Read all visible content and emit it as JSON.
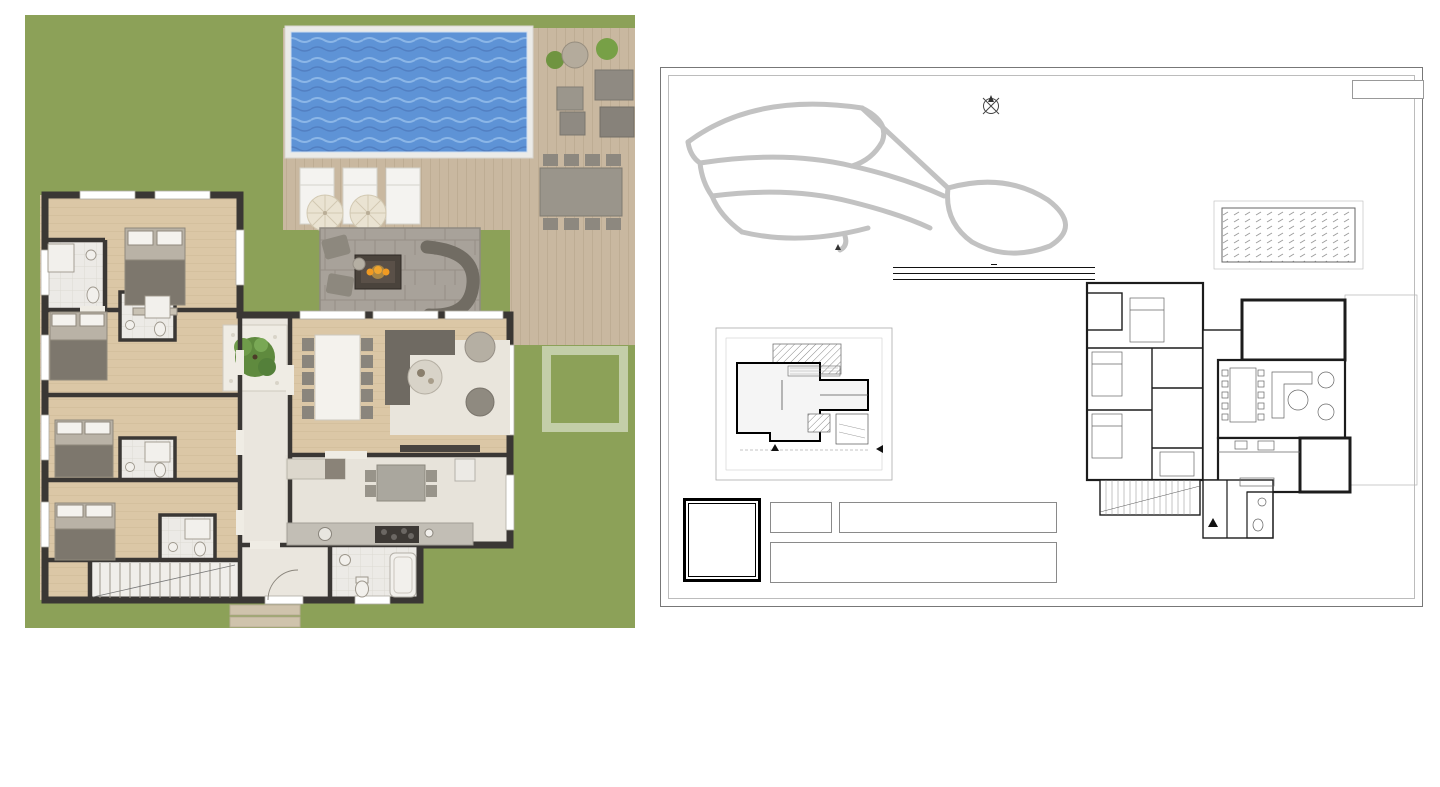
{
  "watermark": {
    "logo_letter": "T",
    "ghost_text": "TE"
  },
  "left_plan": {
    "room_labels": [
      "E YATAK ODASI",
      "E.BANYO",
      "BANYO",
      "YATAK ODASI",
      "YATAK ODASI",
      "BANYO",
      "YATAK ODASI",
      "BANYO",
      "HOL",
      "MUTFAK",
      "ANTRE",
      "WC"
    ]
  },
  "sheet": {
    "uygulama_label": "UYGULAMA",
    "compass_letter": "K",
    "site_plan": {
      "entry_label": "SİTE GİRİŞİ"
    },
    "net_table": {
      "title": "NET ALANLAR :",
      "header": {
        "label": "DAİRE İÇİ NET ALANLAR",
        "value": ": 159,66 m²"
      },
      "rows": [
        {
          "label": "ANTRE",
          "value": ": 3,29 m²"
        },
        {
          "label": "VESTİYER",
          "value": ": 3,06 m²"
        },
        {
          "label": "SALON",
          "value": ": 39,83 m²"
        },
        {
          "label": "MUTFAK",
          "value": ": 15,01 m²"
        },
        {
          "label": "WC",
          "value": ": 2,60 m²"
        },
        {
          "label": "HOL",
          "value": ": 13,48 m²"
        },
        {
          "label": "YATAK ODASI-1",
          "value": ": 14,98 m²"
        },
        {
          "label": "BANYO-1",
          "value": ": 3,41 m²"
        },
        {
          "label": "YATAK ODASI-2",
          "value": ": 13,84 m²"
        },
        {
          "label": "BANYO-2",
          "value": ": 2,92 m²"
        },
        {
          "label": "YATAK ODASI-3",
          "value": ": 14,06 m²"
        },
        {
          "label": "BANYO-3",
          "value": ": 3,28 m²"
        },
        {
          "label": "E.YATAK ODASI",
          "value": ": 20,71 m²"
        },
        {
          "label": "E.BANYO",
          "value": ": 3,50 m²"
        },
        {
          "label": "MERDİVEN",
          "value": ": 5,69 m²"
        }
      ],
      "subtotal": {
        "label": "TAHSİSLİ NET ALANLAR",
        "value": ": 130,50 m²"
      },
      "extra_rows": [
        {
          "label": "HAVUZ",
          "value": ": 32,00 m²"
        },
        {
          "label": "KIŞ BAHÇESİ - 1",
          "value": ": 18,79 m²"
        },
        {
          "label": "KIŞ BAHÇESİ - 2",
          "value": ": 7,78 m²"
        },
        {
          "label": "TERAS",
          "value": ": 71,93 m²"
        }
      ],
      "total": {
        "label": "BAHÇE",
        "value": ": 383,23 m²"
      }
    },
    "key_plan": {
      "havuz": "HAVUZ",
      "teras": "TERAS",
      "bahce": "BAHÇE",
      "otopark": "OTOPARK",
      "villa_entry_line1": "VİLLA",
      "villa_entry_line2": "GİRİŞİ",
      "garden_entry_line1": "BAHÇE",
      "garden_entry_line2": "GİRİŞİ"
    },
    "floor_plan": {
      "rooms": [
        {
          "name": "E YATAK ODASI",
          "area": "A: 20,71 m²"
        },
        {
          "name": "E.BANYO",
          "area": "A: 3,50 m²"
        },
        {
          "name": "BANYO-2",
          "area": "A: 2,92 m²"
        },
        {
          "name": "YATAK ODASI-2",
          "area": "A: 13,84 m²"
        },
        {
          "name": "YATAK ODASI-3",
          "area": "A: 14,06 m²"
        },
        {
          "name": "BANYO-3",
          "area": "A: 3,28 m²"
        },
        {
          "name": "YATAK ODASI-1",
          "area": "A: 14,98 m²"
        },
        {
          "name": "BANYO-1",
          "area": "A: 3,41 m²"
        },
        {
          "name": "HOL",
          "area": "A: 13,48 m²"
        },
        {
          "name": "MERDİVEN",
          "area": "A: 5,69 m²"
        },
        {
          "name": "ANTRE",
          "area": "A: 3,29 m²"
        },
        {
          "name": "VESTİYER",
          "area": "A: 3,06 m²"
        },
        {
          "name": "WC",
          "area": "A: 2,60 m²"
        },
        {
          "name": "MUTFAK",
          "area": "A: 15,01 m²"
        },
        {
          "name": "KIŞ BAHÇESİ - 2",
          "area": "A: 7,78 m²"
        },
        {
          "name": "SALON",
          "area": "A: 39,83 m²"
        },
        {
          "name": "KIŞ BAHÇESİ - 1",
          "area": "A: 18,79 m²"
        },
        {
          "name": "TERAS",
          "area": "A: 71,93 m²"
        }
      ],
      "villa_entry_line1": "VİLLA",
      "villa_entry_line2": "GİRİŞİ"
    },
    "title_block": {
      "unit_label_line1": "Bağ. Böl.",
      "unit_label_line2": "No:",
      "unit_no": "BS-1",
      "room_count": "6+1",
      "plan_title": "E TİPİ VİLLA  ZEMİN KAT",
      "info_lines": [
        "SATIŞA ESAS DAİRE BRÜT ALANI: 422,76 m²",
        "VİLLA TOPLAM NET ALAN: 236,73 m²",
        "TOPLAM PARSEL ALANI: 705,00 m²"
      ]
    }
  }
}
